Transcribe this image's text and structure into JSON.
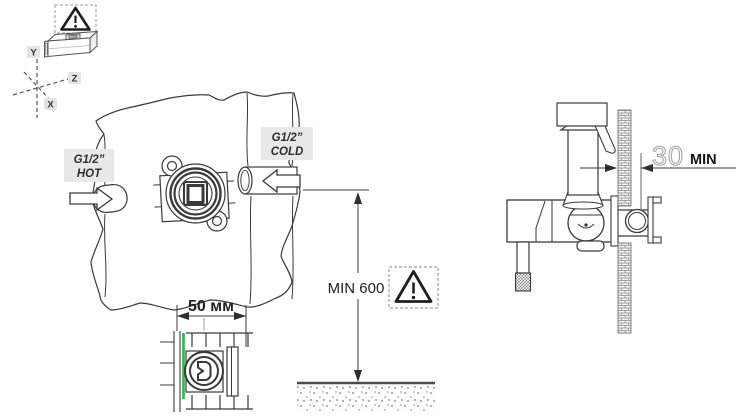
{
  "drawing": {
    "kind": "installation-diagram",
    "axes": {
      "y": "Y",
      "z": "Z",
      "x": "X"
    },
    "connections": {
      "hot": {
        "size": "G1/2”",
        "label": "HOT"
      },
      "cold": {
        "size": "G1/2”",
        "label": "COLD"
      }
    },
    "dimensions": {
      "valve_depth": {
        "text": "50 мм"
      },
      "mounting_height": {
        "text": "MIN 600"
      },
      "wall_clearance": {
        "value": "30",
        "unit": "MIN"
      }
    },
    "icons": {
      "caution": "warning-triangle-icon",
      "level": "spirit-level-icon",
      "orientation": "xyz-axes-icon"
    },
    "colors": {
      "line": "#3a3a3a",
      "label_chip": "#e8e8e8",
      "finished_wall_green": "#31b44b",
      "dim_outline_gray": "#a6a6a6",
      "floor_line": "#4a4a4a"
    }
  }
}
